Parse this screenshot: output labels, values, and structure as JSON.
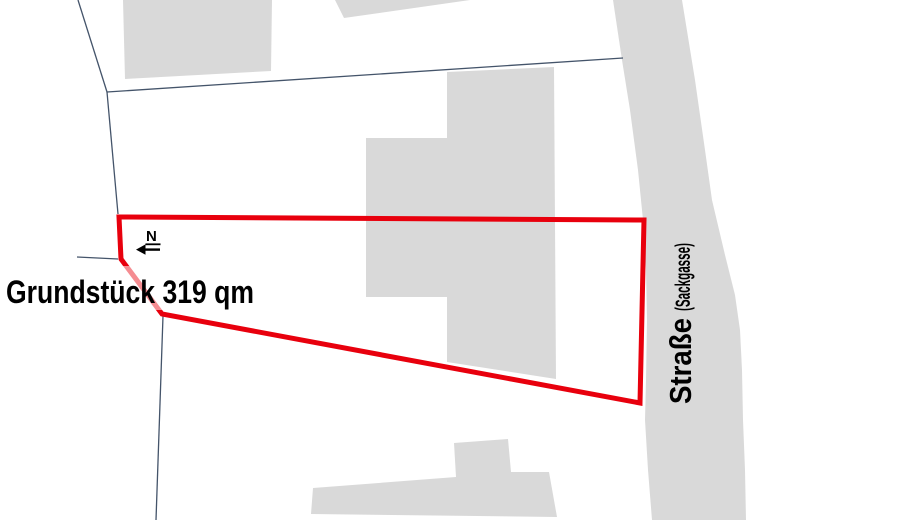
{
  "canvas": {
    "width": 924,
    "height": 520,
    "background": "#ffffff"
  },
  "colors": {
    "building_fill": "#d9d9d9",
    "street_fill": "#d9d9d9",
    "boundary_line": "#44546a",
    "plot_outline": "#e8000d",
    "text": "#000000",
    "label_bg_opacity": 0.55
  },
  "map": {
    "street": {
      "points": [
        [
          613,
          0
        ],
        [
          622,
          60
        ],
        [
          630,
          110
        ],
        [
          638,
          170
        ],
        [
          643,
          220
        ],
        [
          646,
          270
        ],
        [
          647,
          320
        ],
        [
          646,
          380
        ],
        [
          645,
          420
        ],
        [
          648,
          470
        ],
        [
          652,
          520
        ],
        [
          746,
          520
        ],
        [
          745,
          470
        ],
        [
          743,
          420
        ],
        [
          742,
          370
        ],
        [
          740,
          330
        ],
        [
          735,
          295
        ],
        [
          725,
          255
        ],
        [
          712,
          200
        ],
        [
          705,
          150
        ],
        [
          695,
          80
        ],
        [
          682,
          0
        ]
      ]
    },
    "buildings": [
      {
        "id": "building-top-left",
        "points": [
          [
            123,
            0
          ],
          [
            272,
            0
          ],
          [
            271,
            71
          ],
          [
            125,
            79
          ]
        ]
      },
      {
        "id": "building-top-middle",
        "points": [
          [
            335,
            0
          ],
          [
            470,
            0
          ],
          [
            344,
            18
          ]
        ]
      },
      {
        "id": "building-center",
        "points": [
          [
            447,
            72
          ],
          [
            554,
            67
          ],
          [
            556,
            379
          ],
          [
            447,
            362
          ],
          [
            447,
            297
          ],
          [
            366,
            297
          ],
          [
            366,
            138
          ],
          [
            447,
            138
          ]
        ]
      },
      {
        "id": "building-bottom",
        "points": [
          [
            311,
            514
          ],
          [
            313,
            488
          ],
          [
            456,
            477
          ],
          [
            454,
            443
          ],
          [
            508,
            439
          ],
          [
            511,
            472
          ],
          [
            549,
            472
          ],
          [
            557,
            517
          ]
        ]
      }
    ],
    "boundary_lines": [
      {
        "from": [
          78,
          0
        ],
        "to": [
          107,
          92
        ]
      },
      {
        "from": [
          107,
          92
        ],
        "to": [
          623,
          58
        ]
      },
      {
        "from": [
          107,
          92
        ],
        "to": [
          118,
          214
        ]
      },
      {
        "from": [
          77,
          257
        ],
        "to": [
          118,
          259
        ]
      },
      {
        "from": [
          163,
          316
        ],
        "to": [
          156,
          520
        ]
      }
    ],
    "boundary_stroke_width": 1.3,
    "plot": {
      "points": [
        [
          119,
          217
        ],
        [
          644,
          220
        ],
        [
          640,
          403
        ],
        [
          162,
          314
        ],
        [
          121,
          259
        ]
      ],
      "stroke_width": 5
    }
  },
  "labels": {
    "plot_area": {
      "text": "Grundstück 319 qm",
      "text_length": 248
    },
    "north": {
      "letter": "N"
    },
    "street_name": {
      "main": "Straße",
      "sub": "(Sackgasse)"
    }
  }
}
